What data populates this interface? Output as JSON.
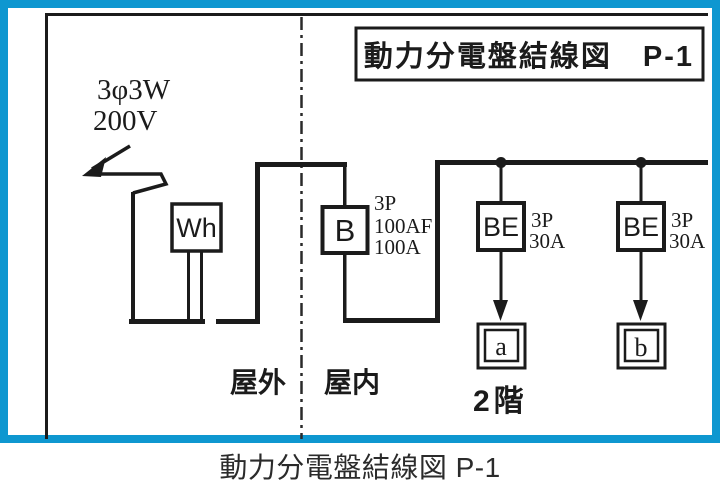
{
  "colors": {
    "panel_border": "#0e97d0",
    "ink": "#1b1b1b"
  },
  "diagram": {
    "title": "動力分電盤結線図　P-1",
    "supply": {
      "phase": "3φ3W",
      "voltage": "200V"
    },
    "zone_boundary": {
      "outdoor": "屋外",
      "indoor": "屋内"
    },
    "meter": {
      "label": "Wh"
    },
    "main_breaker": {
      "label": "B",
      "specs": [
        "3P",
        "100AF",
        "100A"
      ]
    },
    "branch_breakers": [
      {
        "label": "BE",
        "specs": [
          "3P",
          "30A"
        ],
        "load": "a"
      },
      {
        "label": "BE",
        "specs": [
          "3P",
          "30A"
        ],
        "load": "b"
      }
    ],
    "floor_label": "2階"
  },
  "caption": "動力分電盤結線図 P-1"
}
